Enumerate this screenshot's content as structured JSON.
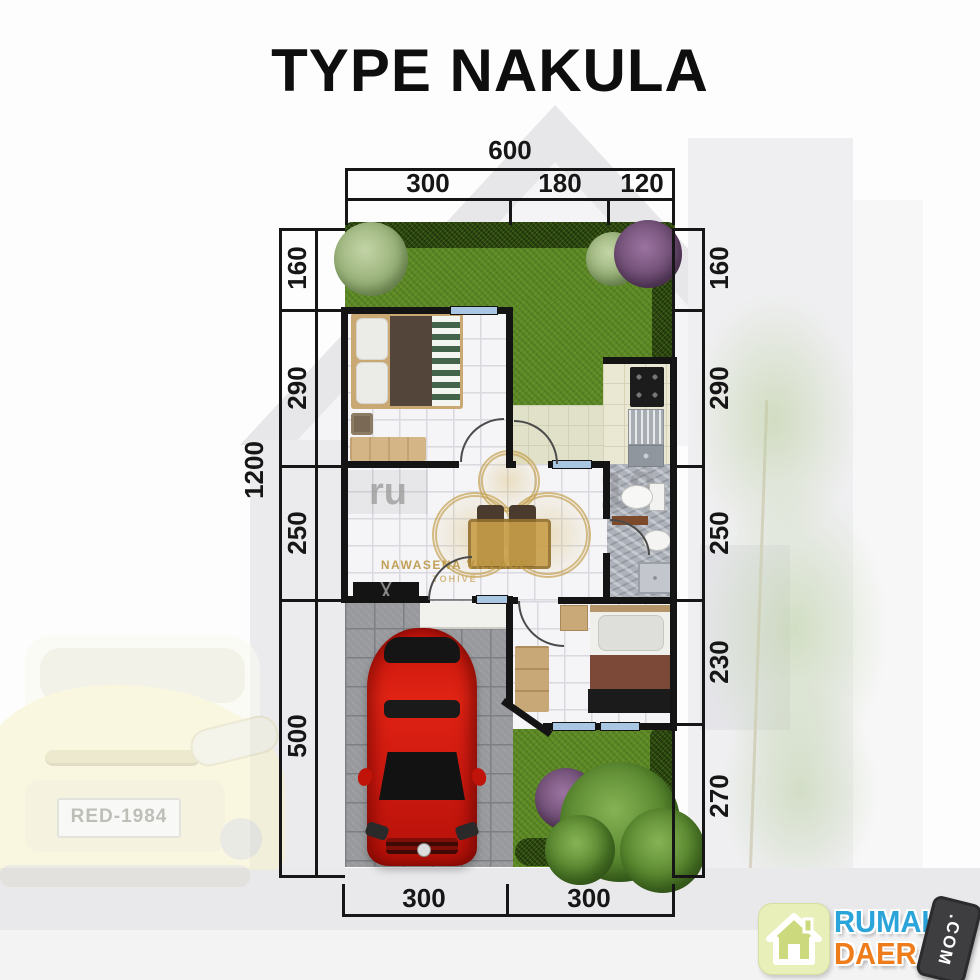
{
  "title": "TYPE NAKULA",
  "dims": {
    "top": {
      "total": "600",
      "segments": [
        "300",
        "180",
        "120"
      ]
    },
    "left": {
      "total": "1200",
      "segments": [
        "160",
        "290",
        "250",
        "500"
      ]
    },
    "right": {
      "segments": [
        "160",
        "290",
        "250",
        "230",
        "270"
      ]
    },
    "bottom": {
      "segments": [
        "300",
        "300"
      ]
    }
  },
  "background": {
    "license_plate": "RED-1984"
  },
  "plan_watermark": {
    "name": "NAWASENA VILLAGE",
    "subname": "TOHIVE",
    "fragment_left": "ru",
    "fragment_right": "18"
  },
  "logo": {
    "word1": "RUMAH",
    "word2": "DAERAH",
    "tag": ".COM"
  },
  "colors": {
    "wall": "#141414",
    "lawn_green": "#5d8a25",
    "hedge_green": "#2c490f",
    "car_red": "#d01a10",
    "logo_blue": "#2ba4d9",
    "logo_orange": "#ef7c1b"
  }
}
